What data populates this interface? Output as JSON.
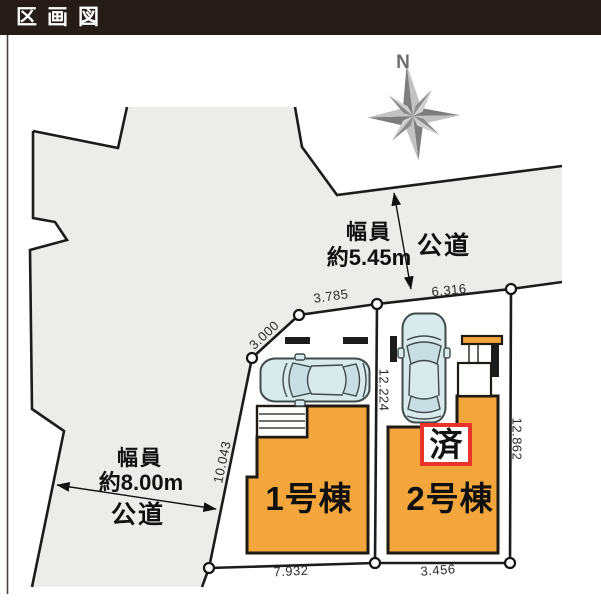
{
  "header": {
    "title": "区画図"
  },
  "compass": {
    "label": "N"
  },
  "roads": {
    "north": {
      "width_line1": "幅員",
      "width_line2": "約5.45m",
      "type": "公道"
    },
    "west": {
      "width_line1": "幅員",
      "width_line2": "約8.00m",
      "type": "公道"
    }
  },
  "lots": {
    "lot1": {
      "building_label": "1号棟",
      "dims": {
        "upper_left": "3.000",
        "top": "3.785",
        "left": "10.043",
        "bottom": "7.932"
      }
    },
    "lot2": {
      "building_label": "2号棟",
      "status_badge": "済",
      "dims": {
        "top": "6.316",
        "divider": "12.224",
        "right": "12.862",
        "bottom": "3.456"
      }
    }
  },
  "colors": {
    "title_bg": "#251c17",
    "road_surface": "#ececeb",
    "building_fill": "#f2a63c",
    "badge_border": "#e8332a",
    "line": "#1c1c1c"
  }
}
